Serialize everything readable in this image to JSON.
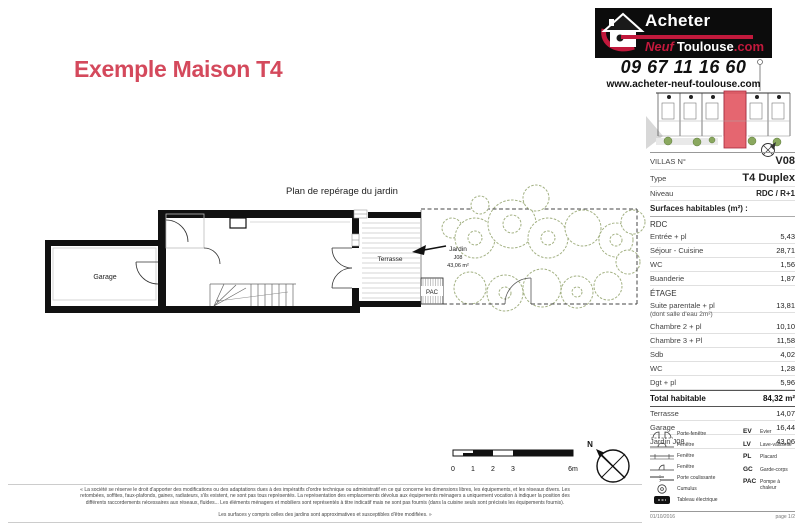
{
  "title": "Exemple Maison T4",
  "colors": {
    "brand_red": "#c2193c",
    "title_red": "#d4495c",
    "foliage_green": "#a3b183",
    "highlight_unit_red": "#e25560"
  },
  "brand": {
    "logo": {
      "line1": "Acheter",
      "neuf": "Neuf",
      "toulouse": "Toulouse",
      "dotcom": ".com"
    },
    "phone": "09 67 11 16 60",
    "website": "www.acheter-neuf-toulouse.com"
  },
  "plan": {
    "caption": "Plan de repérage du jardin",
    "labels": {
      "garage": "Garage",
      "terrasse": "Terrasse",
      "jardin_line1": "Jardin",
      "jardin_line2": "J08",
      "jardin_line3": "43,06 m²",
      "pac": "PAC"
    },
    "scale_ticks": [
      "0",
      "1",
      "2",
      "3",
      "6m"
    ],
    "compass_north": "N"
  },
  "info": {
    "villas_label": "VILLAS N°",
    "villas_value": "V08",
    "type_label": "Type",
    "type_value": "T4 Duplex",
    "niveau_label": "Niveau",
    "niveau_value": "RDC / R+1",
    "surfaces_title": "Surfaces habitables (m²) :",
    "sections": [
      {
        "title": "RDC",
        "rows": [
          {
            "label": "Entrée + pl",
            "value": "5,43"
          },
          {
            "label": "Séjour - Cuisine",
            "value": "28,71"
          },
          {
            "label": "WC",
            "value": "1,56"
          },
          {
            "label": "Buanderie",
            "value": "1,87"
          }
        ]
      },
      {
        "title": "ÉTAGE",
        "rows": [
          {
            "label": "Suite parentale + pl",
            "value": "13,81"
          },
          {
            "label": "(dont salle d'eau 2m²)",
            "value": ""
          },
          {
            "label": "Chambre 2 + pl",
            "value": "10,10"
          },
          {
            "label": "Chambre 3 + Pl",
            "value": "11,58"
          },
          {
            "label": "Sdb",
            "value": "4,02"
          },
          {
            "label": "WC",
            "value": "1,28"
          },
          {
            "label": "Dgt + pl",
            "value": "5,96"
          }
        ]
      }
    ],
    "total_label": "Total habitable",
    "total_value": "84,32 m²",
    "annex_rows": [
      {
        "label": "Terrasse",
        "value": "14,07"
      },
      {
        "label": "Garage",
        "value": "16,44"
      },
      {
        "label": "Jardin J08",
        "value": "43,06"
      }
    ]
  },
  "legend": {
    "symbols": [
      {
        "symbol": "porte-fenetre",
        "label": "Porte-fenêtre"
      },
      {
        "symbol": "fenetre",
        "label": "Fenêtre"
      },
      {
        "symbol": "fenetre",
        "label": "Fenêtre"
      },
      {
        "symbol": "fenetre",
        "label": "Fenêtre"
      },
      {
        "symbol": "porte-coulissante",
        "label": "Porte coulissante"
      },
      {
        "symbol": "cumulus",
        "label": "Cumulus"
      },
      {
        "symbol": "tableau-electrique",
        "label": "Tableau électrique"
      }
    ],
    "abbreviations": [
      {
        "abbr": "EV",
        "label": "Evier"
      },
      {
        "abbr": "LV",
        "label": "Lave-vaisselle"
      },
      {
        "abbr": "PL",
        "label": "Placard"
      },
      {
        "abbr": "GC",
        "label": "Garde-corps"
      },
      {
        "abbr": "PAC",
        "label": "Pompe à chaleur"
      }
    ]
  },
  "footer": {
    "date": "01/10/2016",
    "page": "page 1/2"
  },
  "disclaimer": [
    "« La société se réserve le droit d'apporter des modifications ou des adaptations dues à des impératifs d'ordre technique ou administratif en ce qui concerne les dimensions libres, les équipements, et les réseaux divers. Les",
    "retombées, soffites, faux-plafonds, gaines, radiateurs, s'ils existent, ne sont pas tous représentés. La représentation des emplacements dévolus aux équipements ménagers a uniquement vocation à indiquer la position des",
    "différents raccordements nécessaires aux réseaux, fluides... Les éléments ménagers et mobiliers sont représentés à titre indicatif mais ne sont pas fournis (dans la cuisine seuls sont précisés les équipements fournis).",
    "Les surfaces y compris celles des jardins sont approximatives et susceptibles d'être modifiées. »"
  ]
}
